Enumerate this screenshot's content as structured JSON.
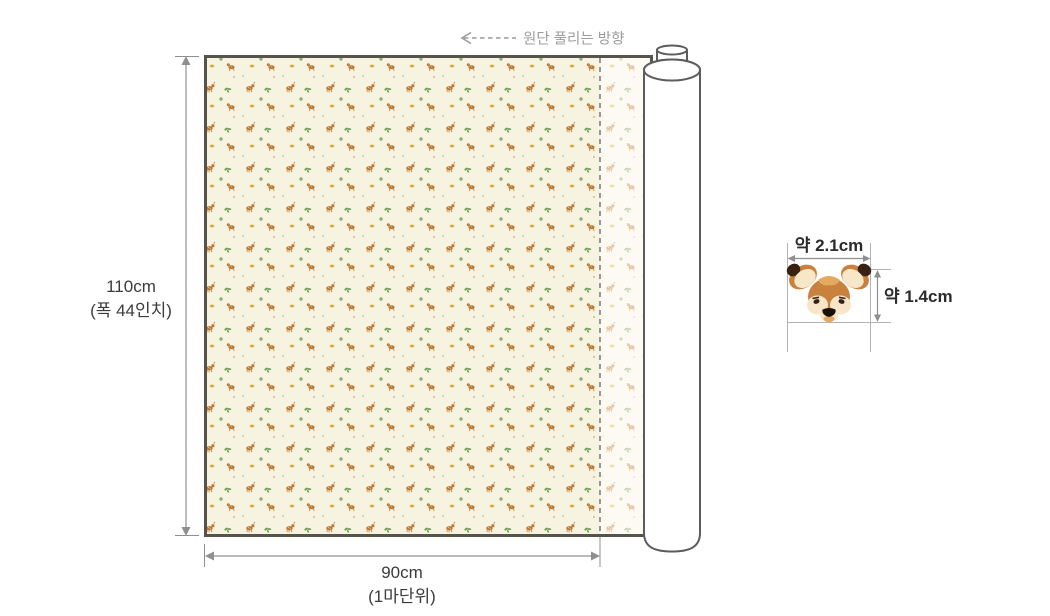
{
  "colors": {
    "page_bg": "#ffffff",
    "fabric_bg": "#f6f3e1",
    "fabric_bg_faded": "#fcfaf2",
    "panel_border": "#55534b",
    "dash_gray": "#7f7f7f",
    "dim_line": "#8f8f8f",
    "dim_text": "#3b3b3b",
    "muted_text": "#9c9c9c",
    "guide_line": "#b3b3b3",
    "roll_outline": "#5c5c5c",
    "roll_fill": "#ffffff",
    "motif_brown": "#bf7a35",
    "motif_green": "#699a4d",
    "motif_yellow": "#e0bc55",
    "motif_cream": "#f6e9c9",
    "deer_brown": "#c9823d",
    "deer_tan": "#e3a95f",
    "deer_cream": "#f7e7c8",
    "deer_dark": "#382113",
    "deer_black": "#191008"
  },
  "annotations": {
    "unroll_direction": "원단 풀리는 방향"
  },
  "fabric": {
    "width_value": "110cm",
    "width_note": "(폭 44인치)",
    "length_value": "90cm",
    "length_note": "(1마단위)"
  },
  "motif_size": {
    "width": "약 2.1cm",
    "height": "약 1.4cm"
  }
}
